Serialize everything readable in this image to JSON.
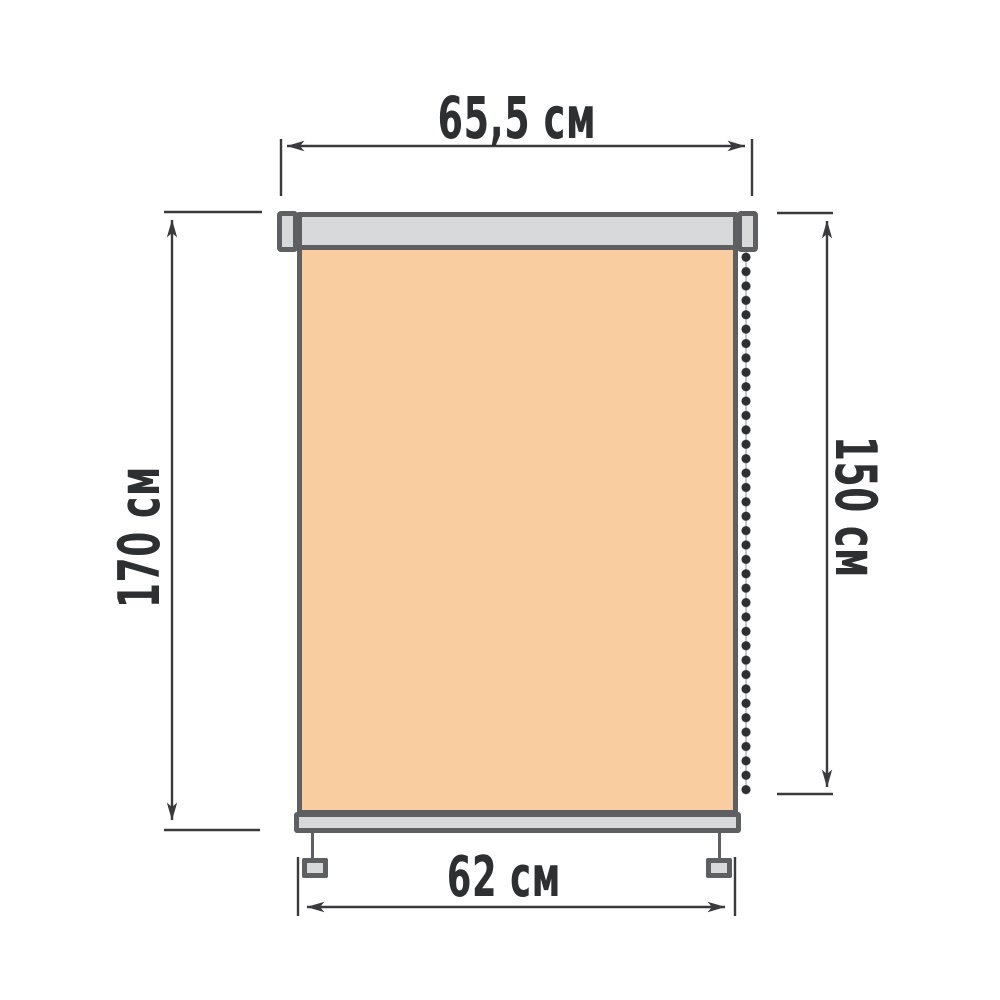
{
  "diagram": {
    "unit": "см",
    "dimensions": {
      "top_width": {
        "label": "65,5 см",
        "value": "65,5"
      },
      "left_height": {
        "label": "170 см",
        "value": "170"
      },
      "right_height": {
        "label": "150 см",
        "value": "150"
      },
      "bottom_width": {
        "label": "62 см",
        "value": "62"
      }
    },
    "colors": {
      "fabric": "#f9cda0",
      "hardware": "#d8d9db",
      "outline": "#5d5f62",
      "dim": "#3a3a3c",
      "text": "#2e2f31",
      "chain": "#2e2f31",
      "cord": "#c6c7c9",
      "bg": "#ffffff"
    }
  }
}
